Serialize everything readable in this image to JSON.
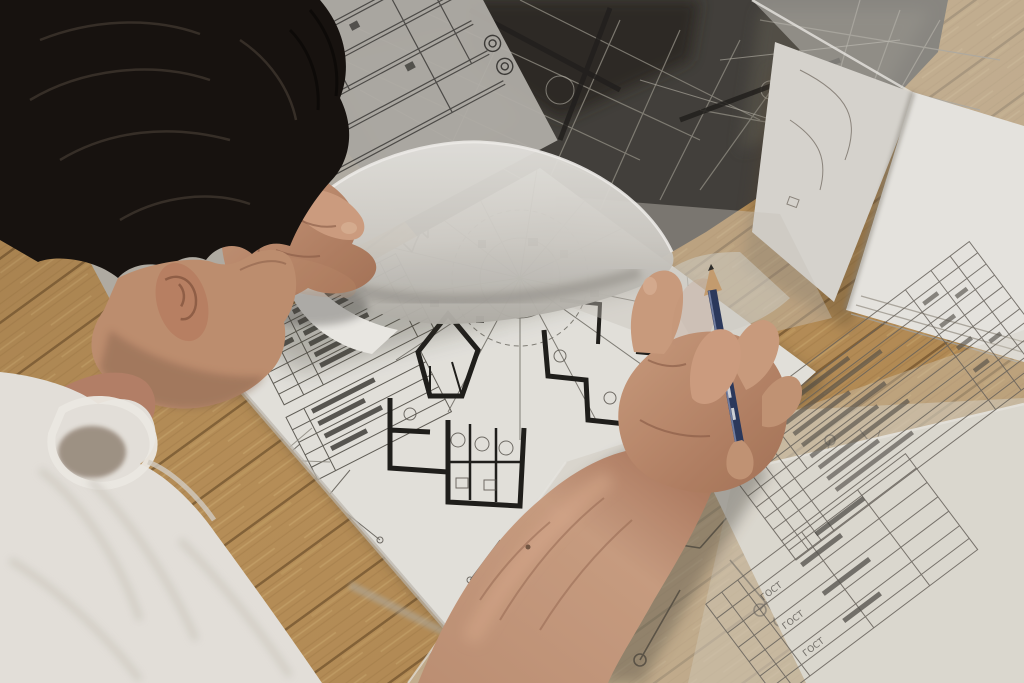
{
  "scene": {
    "kind": "photograph",
    "regions": [
      {
        "name": "wood-floor"
      },
      {
        "name": "dark-structural-drawing"
      },
      {
        "name": "schematic-grid-sheet"
      },
      {
        "name": "notebook-paper-stack"
      },
      {
        "name": "main-blueprint-sheet"
      },
      {
        "name": "radial-floor-plan"
      },
      {
        "name": "title-block-table"
      },
      {
        "name": "lifted-tracing-sheet"
      },
      {
        "name": "circuit-tracing-sheet"
      },
      {
        "name": "spec-table-tracing-sheet"
      },
      {
        "name": "gost-table-sheet"
      },
      {
        "name": "man-head-hair"
      },
      {
        "name": "man-face"
      },
      {
        "name": "man-tshirt-shoulder"
      },
      {
        "name": "left-hand-holding-sheet"
      },
      {
        "name": "right-forearm-hand"
      },
      {
        "name": "blue-pencil"
      }
    ]
  },
  "tables": {
    "gost": {
      "rows": [
        "ГОСТ",
        "ГОСТ",
        "ГОСТ"
      ]
    }
  },
  "colors": {
    "wood": "#b98f58",
    "wood_dark": "#8f6a3c",
    "paper_white": "#eceae5",
    "paper_gray": "#d8d5cf",
    "tracing": "#c9c6bf",
    "dark_drawing": "#45423d",
    "ink": "#3c3a36",
    "hair": "#181310",
    "skin": "#c39272",
    "skin_deep": "#a1725a",
    "shirt": "#eae6df",
    "pencil_navy": "#2d3a5e",
    "pencil_wood": "#caa172",
    "blueprint_paper": "#e9e7e1"
  }
}
